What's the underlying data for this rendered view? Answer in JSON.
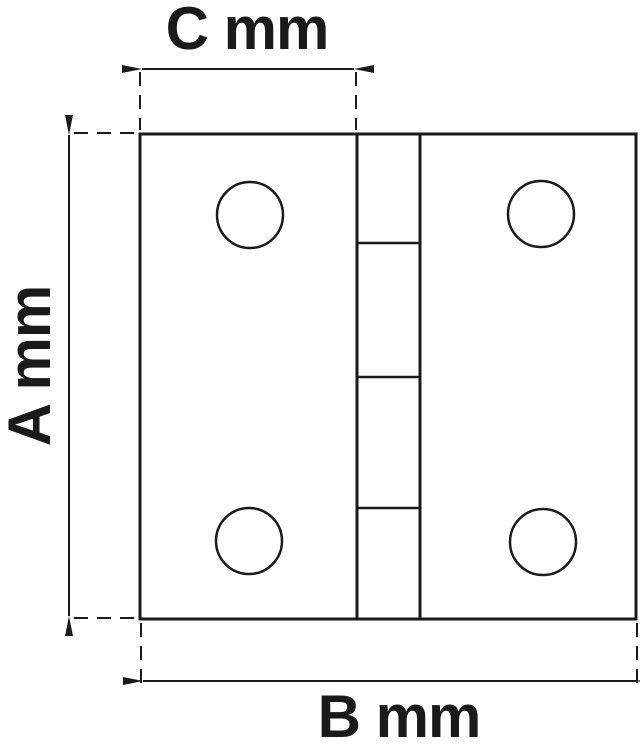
{
  "diagram": {
    "type": "technical-drawing",
    "subject": "butt hinge front view with dimension annotations",
    "labels": {
      "top_width": "C mm",
      "left_height": "A mm",
      "bottom_width": "B mm"
    },
    "colors": {
      "line": "#1a1a1a",
      "background": "#ffffff"
    }
  }
}
